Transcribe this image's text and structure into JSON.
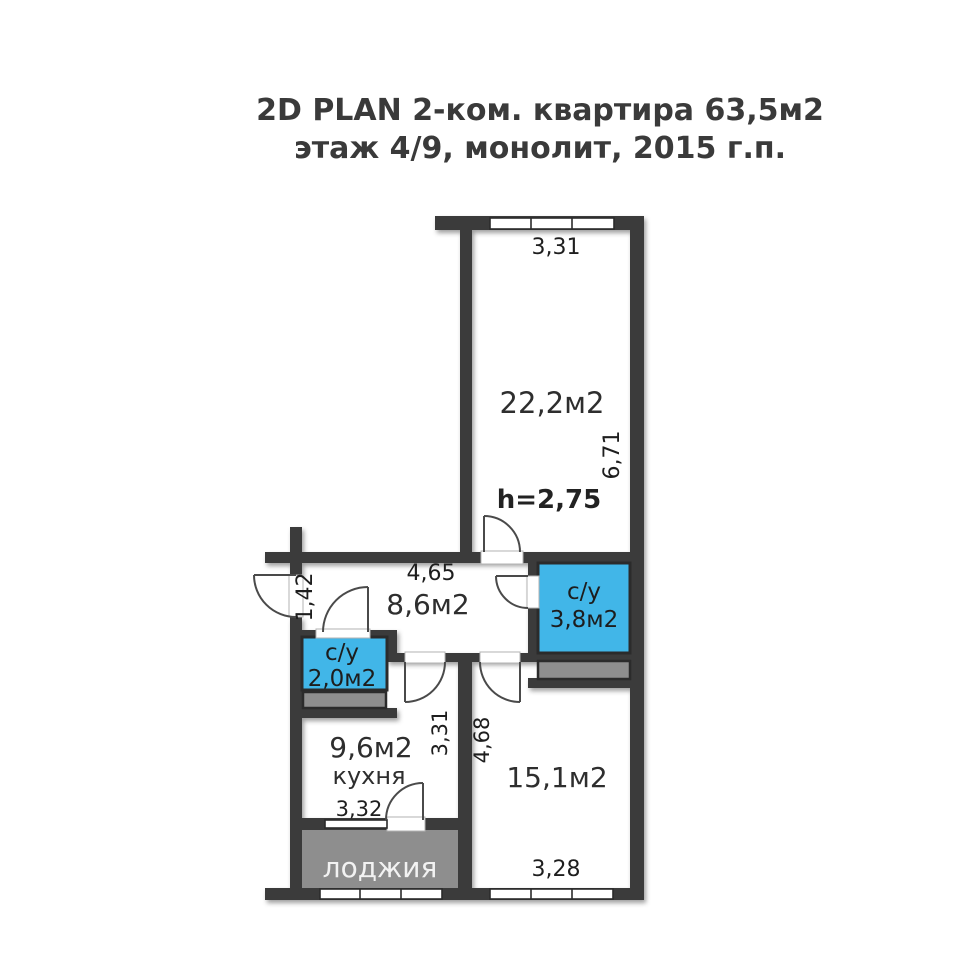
{
  "title": {
    "line1": "2D PLAN 2-ком. квартира 63,5м2",
    "line2": "этаж 4/9, монолит, 2015 г.п."
  },
  "plan": {
    "ceiling_height": "h=2,75",
    "rooms": [
      {
        "id": "living-room",
        "area_label": "22,2м2"
      },
      {
        "id": "hallway",
        "area_label": "8,6м2"
      },
      {
        "id": "bathroom-main",
        "type_label": "с/у",
        "area_label": "3,8м2"
      },
      {
        "id": "bathroom-small",
        "type_label": "с/у",
        "area_label": "2,0м2"
      },
      {
        "id": "kitchen",
        "area_label": "9,6м2",
        "name_label": "кухня"
      },
      {
        "id": "bedroom",
        "area_label": "15,1м2"
      },
      {
        "id": "loggia",
        "name_label": "лоджия"
      }
    ],
    "dimensions": {
      "living_width": "3,31",
      "living_height": "6,71",
      "hall_width": "4,65",
      "entry_width": "1,42",
      "kitchen_height": "3,31",
      "kitchen_width": "3,32",
      "bedroom_height": "4,68",
      "bedroom_width": "3,28"
    },
    "colors": {
      "wall": "#3b3b3b",
      "wet_zone": "#41b6e8",
      "service_gray": "#8e8e8e",
      "background": "#ffffff",
      "text": "#2e2e2e",
      "loggia_text": "#f2f2f2"
    }
  }
}
